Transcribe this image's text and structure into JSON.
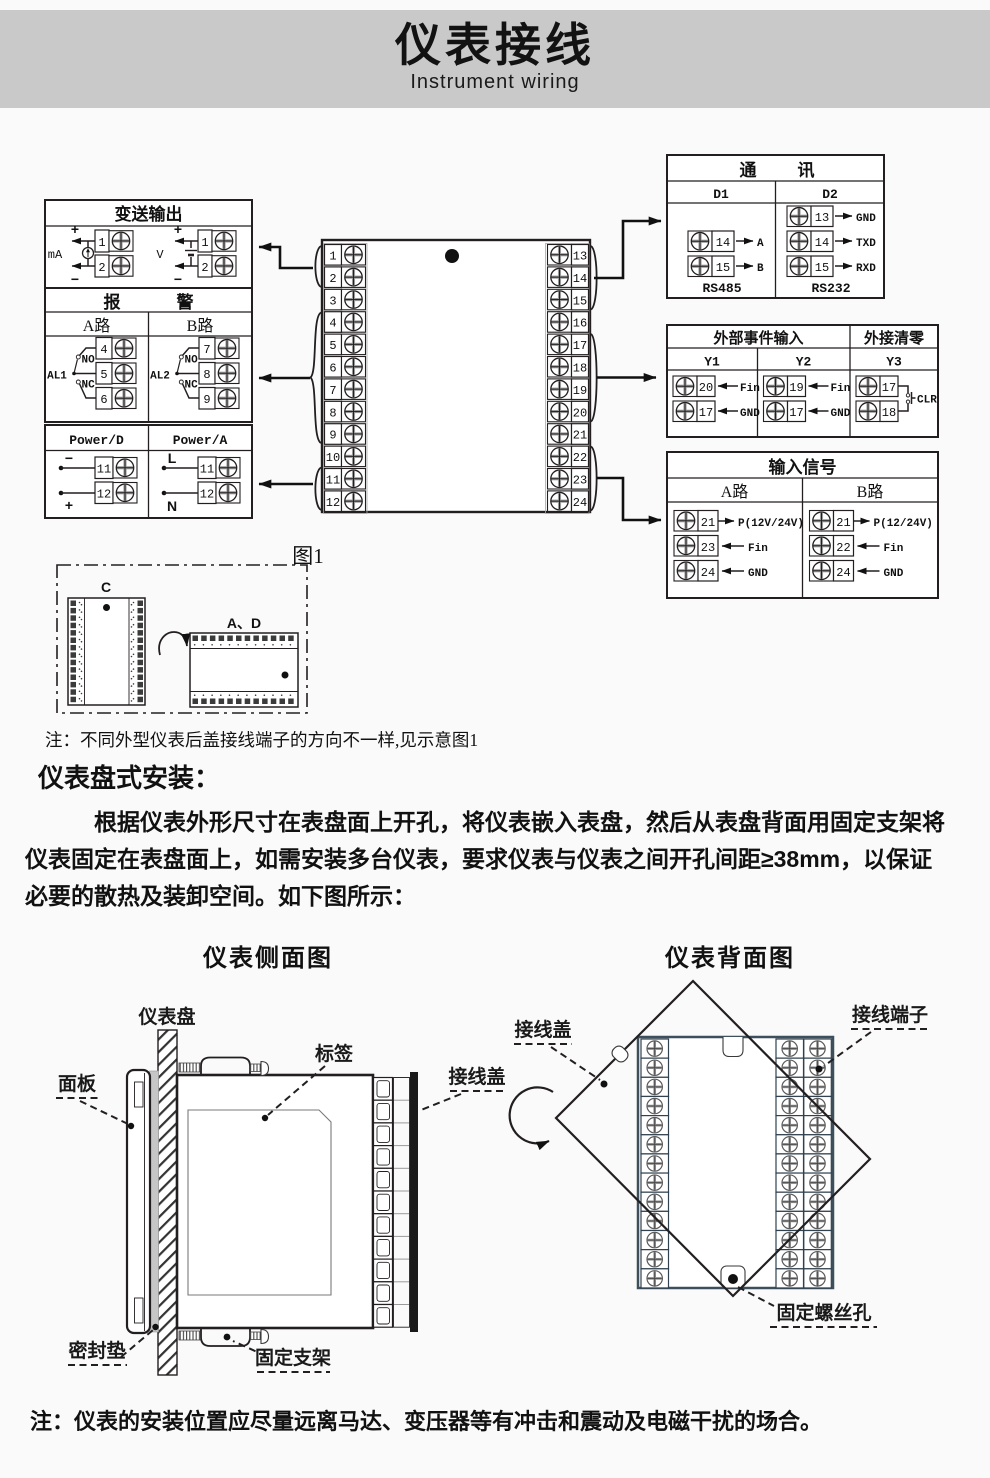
{
  "header": {
    "title": "仪表接线",
    "subtitle": "Instrument wiring"
  },
  "transmitter": {
    "title": "变送输出",
    "ma_label": "mA",
    "v_label": "V",
    "plus": "+",
    "minus": "−",
    "t1": "1",
    "t2": "2"
  },
  "alarm": {
    "title_l": "报",
    "title_r": "警",
    "col_a": "A路",
    "col_b": "B路",
    "a": {
      "relay": "AL1",
      "no": "NO",
      "nc": "NC",
      "t1": "4",
      "t2": "5",
      "t3": "6"
    },
    "b": {
      "relay": "AL2",
      "no": "NO",
      "nc": "NC",
      "t1": "7",
      "t2": "8",
      "t3": "9"
    }
  },
  "power": {
    "col_d": "Power/D",
    "col_a": "Power/A",
    "d": {
      "top": "−",
      "bottom": "+",
      "t1": "11",
      "t2": "12"
    },
    "a": {
      "top": "L",
      "bottom": "N",
      "t1": "11",
      "t2": "12"
    }
  },
  "center_block": {
    "left_terminals": [
      "1",
      "2",
      "3",
      "4",
      "5",
      "6",
      "7",
      "8",
      "9",
      "10",
      "11",
      "12"
    ],
    "right_terminals": [
      "13",
      "14",
      "15",
      "16",
      "17",
      "18",
      "19",
      "20",
      "21",
      "22",
      "23",
      "24"
    ]
  },
  "communication": {
    "title_l": "通",
    "title_r": "讯",
    "col1": "D1",
    "col2": "D2",
    "d1": {
      "t1": "14",
      "l1": "A",
      "t2": "15",
      "l2": "B",
      "caption": "RS485"
    },
    "d2": {
      "t1": "13",
      "l1": "GND",
      "t2": "14",
      "l2": "TXD",
      "t3": "15",
      "l3": "RXD",
      "caption": "RS232"
    }
  },
  "event_input": {
    "title": "外部事件输入",
    "title_clear": "外接清零",
    "col1": "Y1",
    "col2": "Y2",
    "col3": "Y3",
    "y1": {
      "t1": "20",
      "l1": "Fin",
      "t2": "17",
      "l2": "GND"
    },
    "y2": {
      "t1": "19",
      "l1": "Fin",
      "t2": "17",
      "l2": "GND"
    },
    "y3": {
      "t1": "17",
      "t2": "18",
      "label": "CLR"
    }
  },
  "input_signal": {
    "title": "输入信号",
    "col_a": "A路",
    "col_b": "B路",
    "a": {
      "t1": "21",
      "l1": "P(12V/24V)",
      "t2": "23",
      "l2": "Fin",
      "t3": "24",
      "l3": "GND"
    },
    "b": {
      "t1": "21",
      "l1": "P(12/24V)",
      "t2": "22",
      "l2": "Fin",
      "t3": "24",
      "l3": "GND"
    }
  },
  "figure1": {
    "caption": "图1",
    "connector_c": "C",
    "connector_ad": "A、D"
  },
  "notes": {
    "wiring": "注：不同外型仪表后盖接线端子的方向不一样,见示意图1",
    "bottom": "注：仪表的安装位置应尽量远离马达、变压器等有冲击和震动及电磁干扰的场合。"
  },
  "install": {
    "heading": "仪表盘式安装：",
    "paragraph": "根据仪表外形尺寸在表盘面上开孔，将仪表嵌入表盘，然后从表盘背面用固定支架将仪表固定在表盘面上，如需安装多台仪表，要求仪表与仪表之间开孔间距≥38mm，以保证必要的散热及装卸空间。如下图所示：",
    "side_title": "仪表侧面图",
    "back_title": "仪表背面图"
  },
  "side_labels": {
    "panel": "仪表盘",
    "face": "面板",
    "tag": "标签",
    "cover": "接线盖",
    "gasket": "密封垫",
    "bracket": "固定支架"
  },
  "back_labels": {
    "cover": "接线盖",
    "terminal": "接线端子",
    "screw_hole": "固定螺丝孔"
  },
  "colors": {
    "header_bg": "#c9c9c9",
    "line": "#231f20",
    "back_body": "#3d4f5d",
    "gasket": "#c6c6c6",
    "screw_gray": "#9a9a9a"
  }
}
